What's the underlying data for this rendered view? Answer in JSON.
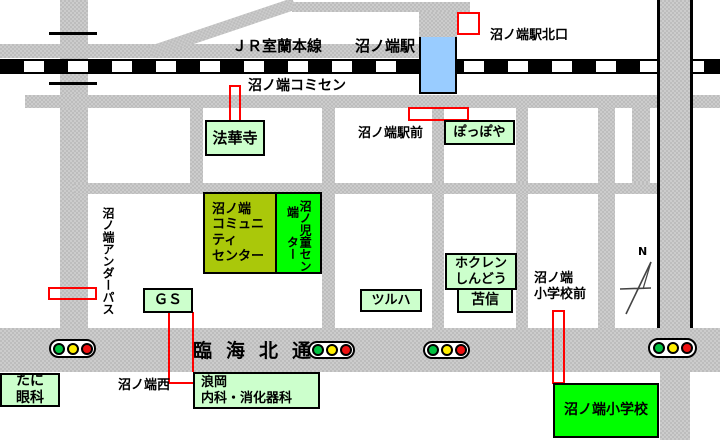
{
  "map": {
    "labels": {
      "jr_line": "ＪＲ室蘭本線",
      "station": "沼ノ端駅",
      "station_north_exit": "沼ノ端駅北口",
      "comisen": "沼ノ端コミセン",
      "station_front": "沼ノ端駅前",
      "underpass": "沼ノ端アンダーパス",
      "main_road": "臨海北通",
      "crossing_west": "沼ノ端西",
      "school_front": "沼ノ端\n小学校前",
      "north": "N"
    },
    "places": {
      "hokkeji": "法華寺",
      "poppoya": "ぽっぽや",
      "community_center": "沼ノ端\nコミュニ\nティ\nセンター",
      "jido_center_right_col": "沼ノ端",
      "jido_center_left_col": "児童センター",
      "gas_station": "ＧＳ",
      "tsuruha": "ツルハ",
      "hokuren_shindo": "ホクレン\nしんどう",
      "tomashin": "苫信",
      "tani_eye_clinic": "たに\n眼科",
      "namioka_clinic": "浪岡\n内科・消化器科",
      "elementary_school": "沼ノ端小学校"
    },
    "colors": {
      "road_gray": "#c6c6c6",
      "pale_green": "#ccffcc",
      "bright_green": "#00ff00",
      "olive_green": "#aac80a",
      "station_blue": "#99ccff",
      "marker_red": "#ff0000",
      "signal_green": "#00c040",
      "signal_yellow": "#ffee00",
      "signal_red": "#ee1111"
    }
  }
}
